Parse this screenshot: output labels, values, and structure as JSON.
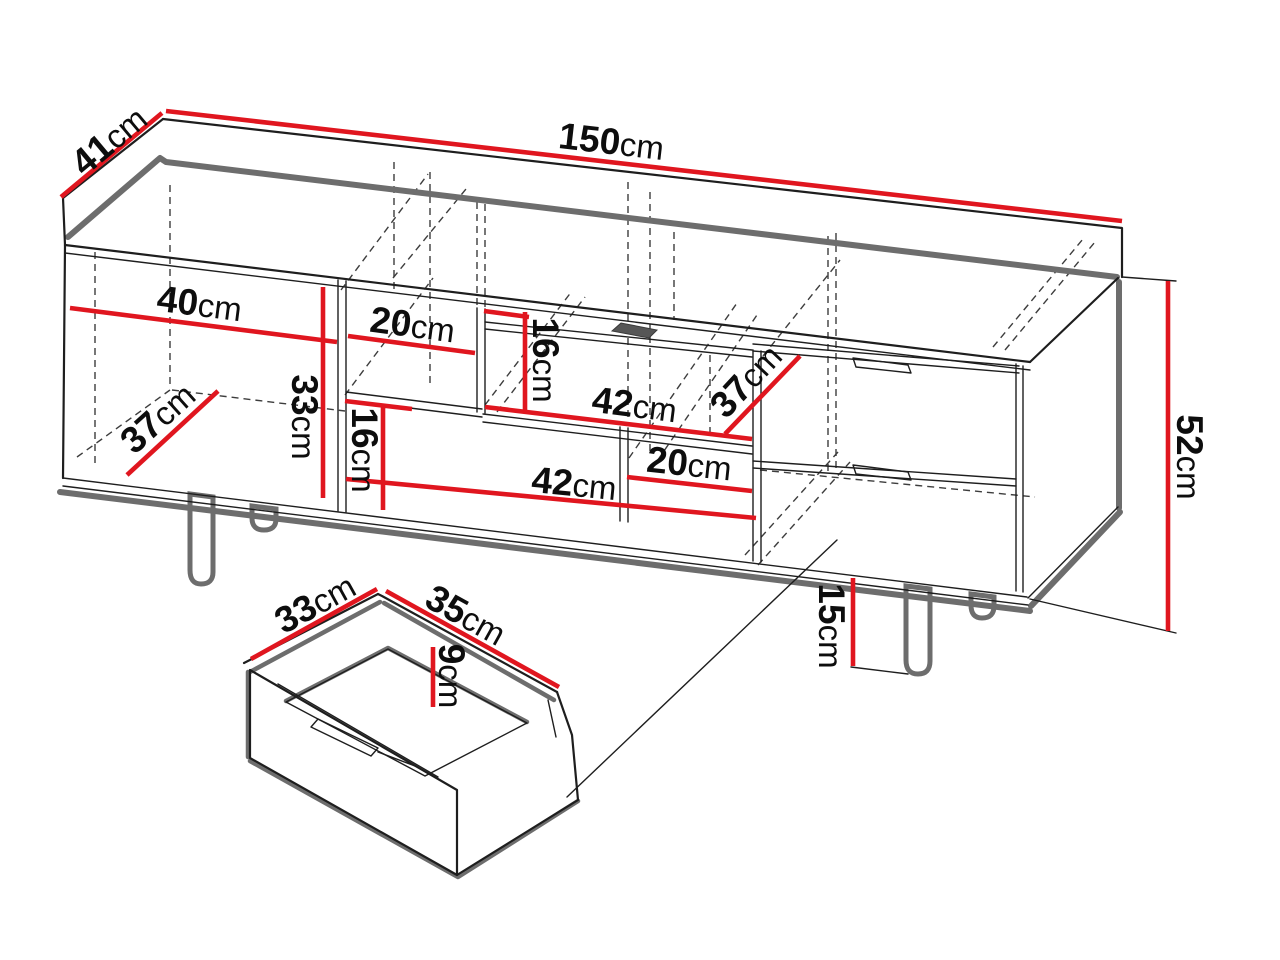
{
  "colors": {
    "dimension_line": "#e0161f",
    "outline": "#1e1e1e",
    "shadow_edge": "#6d6d6d",
    "background": "#ffffff"
  },
  "labels": {
    "total_width": {
      "num": "150",
      "unit": "cm"
    },
    "total_depth": {
      "num": "41",
      "unit": "cm"
    },
    "total_height": {
      "num": "52",
      "unit": "cm"
    },
    "door_width": {
      "num": "40",
      "unit": "cm"
    },
    "door_inner_depth": {
      "num": "37",
      "unit": "cm"
    },
    "door_inner_height": {
      "num": "33",
      "unit": "cm"
    },
    "top_shelf_width": {
      "num": "20",
      "unit": "cm"
    },
    "top_shelf_height": {
      "num": "16",
      "unit": "cm"
    },
    "flap_width": {
      "num": "42",
      "unit": "cm"
    },
    "flap_depth": {
      "num": "37",
      "unit": "cm"
    },
    "open_shelf_width": {
      "num": "42",
      "unit": "cm"
    },
    "open_shelf_height": {
      "num": "16",
      "unit": "cm"
    },
    "niche_width": {
      "num": "20",
      "unit": "cm"
    },
    "leg_height": {
      "num": "15",
      "unit": "cm"
    },
    "drawer_depth": {
      "num": "33",
      "unit": "cm"
    },
    "drawer_width": {
      "num": "35",
      "unit": "cm"
    },
    "drawer_height": {
      "num": "9",
      "unit": "cm"
    }
  }
}
